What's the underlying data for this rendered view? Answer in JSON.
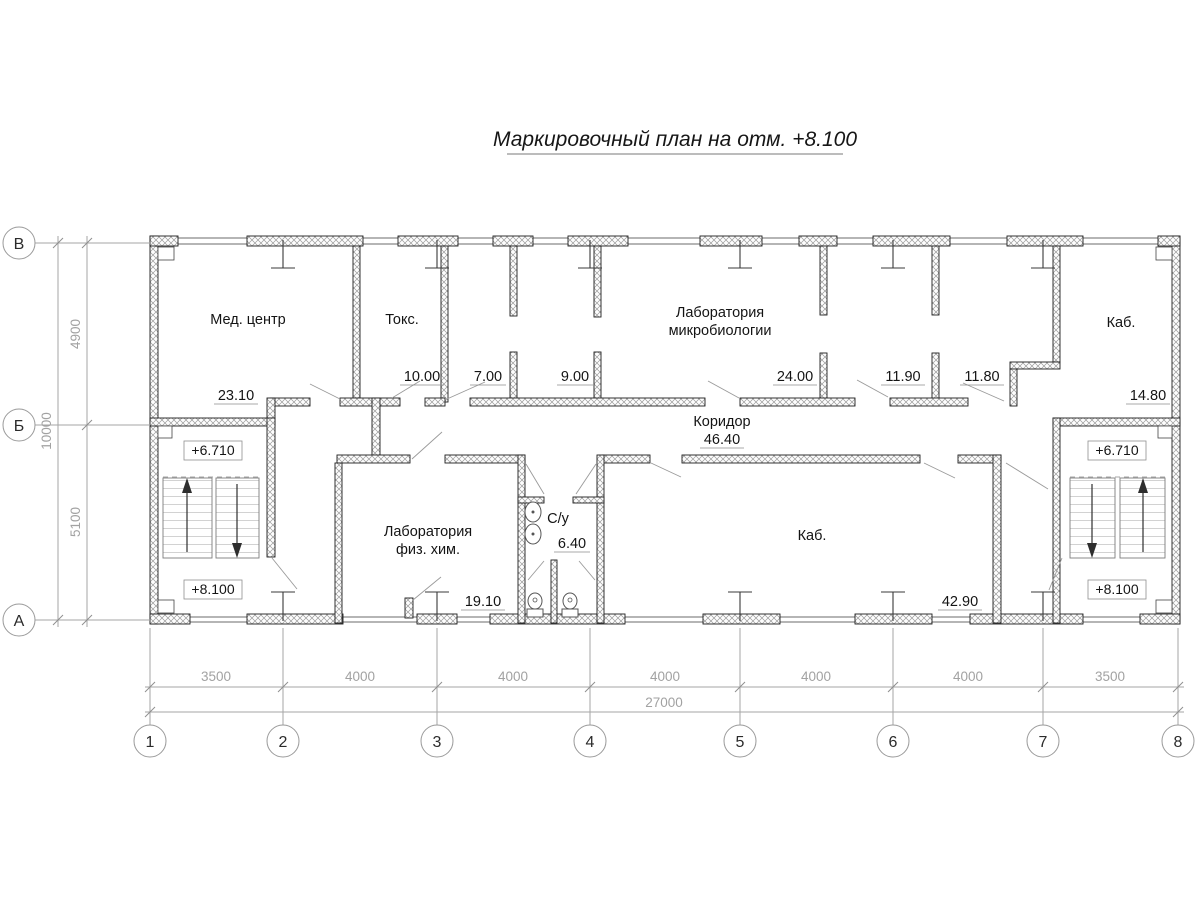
{
  "title": "Маркировочный план на отм. +8.100",
  "rooms": {
    "med_center": {
      "label": "Мед. центр",
      "area": "23.10"
    },
    "toks": {
      "label": "Токс.",
      "area": "10.00"
    },
    "room7": {
      "area": "7.00"
    },
    "room9": {
      "area": "9.00"
    },
    "lab_micro": {
      "label_line1": "Лаборатория",
      "label_line2": "микробиологии",
      "area": "24.00"
    },
    "room1190": {
      "area": "11.90"
    },
    "room1180": {
      "area": "11.80"
    },
    "kab_top": {
      "label": "Каб.",
      "area": "14.80"
    },
    "corridor": {
      "label": "Коридор",
      "area": "46.40"
    },
    "lab_fizhim": {
      "label_line1": "Лаборатория",
      "label_line2": "физ. хим.",
      "area": "19.10"
    },
    "su": {
      "label": "С/у",
      "area": "6.40"
    },
    "kab_bottom": {
      "label": "Каб.",
      "area": "42.90"
    }
  },
  "elevations": {
    "upper": "+6.710",
    "lower": "+8.100"
  },
  "axes": {
    "vertical": [
      "В",
      "Б",
      "А"
    ],
    "horizontal": [
      "1",
      "2",
      "3",
      "4",
      "5",
      "6",
      "7",
      "8"
    ]
  },
  "dimensions": {
    "left": {
      "segments": [
        "4900",
        "5100"
      ],
      "total": "10000"
    },
    "bottom": {
      "segments": [
        "3500",
        "4000",
        "4000",
        "4000",
        "4000",
        "4000",
        "3500"
      ],
      "total": "27000"
    }
  }
}
